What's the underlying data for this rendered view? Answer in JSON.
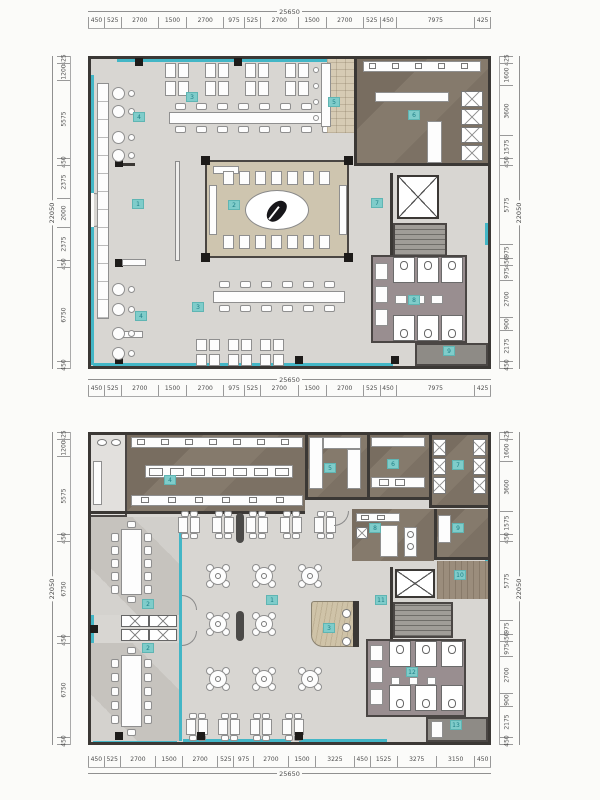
{
  "sheet": {
    "description": "Restaurant architectural floor plans, two levels with dimension strings and numbered room tags",
    "plan1": {
      "name": "upper-floor-plan",
      "labels": [
        "1",
        "2",
        "3",
        "3",
        "4",
        "4",
        "5",
        "6",
        "7",
        "8",
        "9"
      ],
      "dims": {
        "top": {
          "total": "25650",
          "segments": [
            "450",
            "525",
            "2700",
            "1500",
            "2700",
            "975",
            "525",
            "2700",
            "1500",
            "2700",
            "525",
            "450",
            "7975",
            "425"
          ]
        },
        "left": {
          "total": "22050",
          "segments": [
            "425",
            "1200",
            "5575",
            "450",
            "2375",
            "2000",
            "2375",
            "450",
            "6750",
            "450"
          ]
        },
        "right": {
          "total": "22050",
          "segments": [
            "425",
            "1600",
            "3600",
            "1575",
            "450",
            "5775",
            "975",
            "450",
            "975",
            "2700",
            "900",
            "2175",
            "450"
          ]
        }
      }
    },
    "plan2": {
      "name": "lower-floor-plan",
      "labels": [
        "1",
        "2",
        "2",
        "3",
        "4",
        "5",
        "6",
        "7",
        "8",
        "9",
        "10",
        "11",
        "12",
        "13"
      ],
      "dims": {
        "left": {
          "total": "22050",
          "segments": [
            "425",
            "1200",
            "5575",
            "450",
            "6750",
            "450",
            "6750",
            "450"
          ]
        },
        "right": {
          "total": "22050",
          "segments": [
            "425",
            "1600",
            "3600",
            "1575",
            "450",
            "5775",
            "975",
            "450",
            "975",
            "2700",
            "900",
            "2175",
            "450"
          ]
        },
        "bottom": {
          "total": "25650",
          "segments": [
            "450",
            "525",
            "2700",
            "1500",
            "2700",
            "525",
            "975",
            "2700",
            "1500",
            "3225",
            "450",
            "1525",
            "3275",
            "3150",
            "450"
          ]
        }
      }
    },
    "colors": {
      "glazing": "#43b6c6",
      "wall": "#3b3835",
      "label_chip": "#7fccca",
      "stage_floor": "#cec5af",
      "kitchen_floor": "#857a6c",
      "washroom_floor": "#998e90"
    }
  }
}
